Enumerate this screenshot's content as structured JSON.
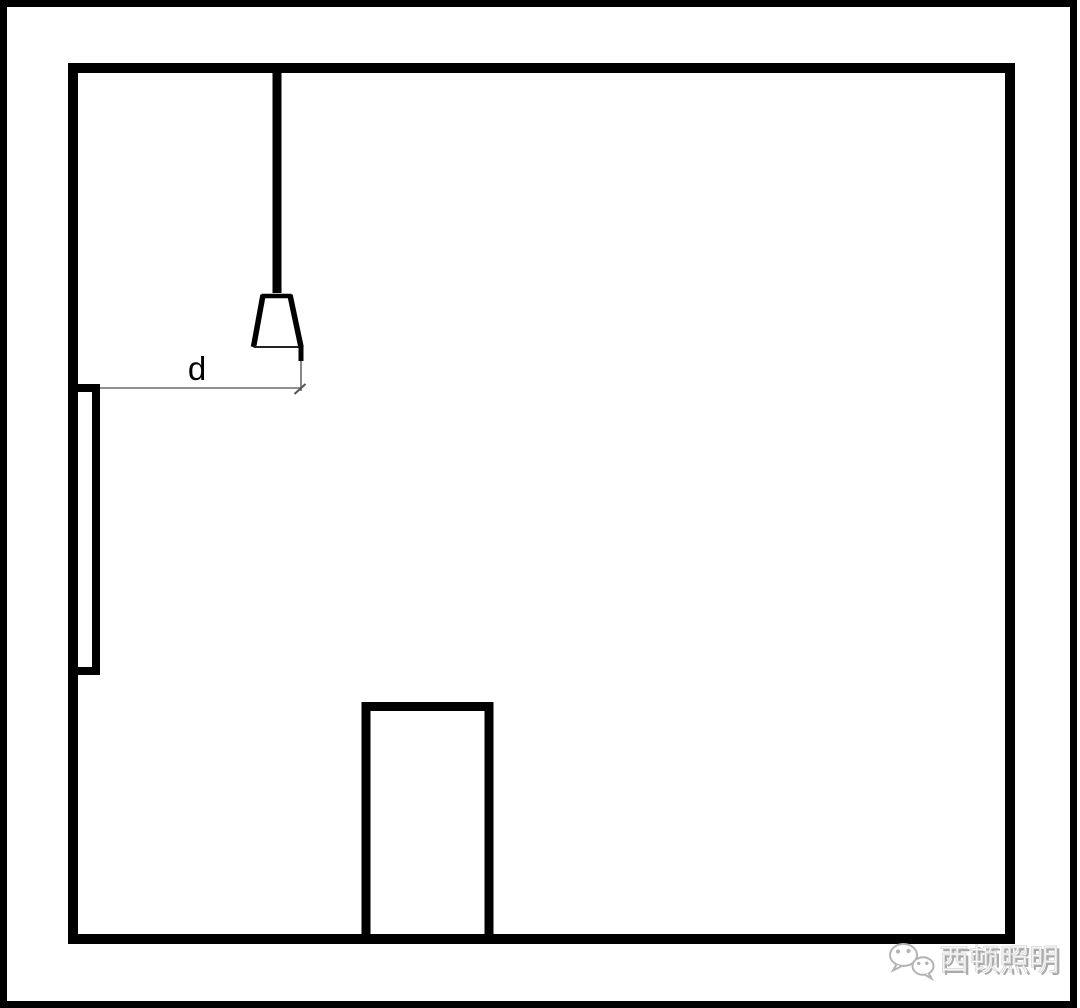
{
  "diagram": {
    "dimension_label": "d",
    "line_color": "#000000",
    "dimension_line_color": "#6b6b6b",
    "background_color": "#ffffff"
  },
  "watermark": {
    "text": "西顿照明",
    "icon": "wechat-icon",
    "color": "#b3b3b3",
    "shadow_color": "#a6a6a6"
  }
}
